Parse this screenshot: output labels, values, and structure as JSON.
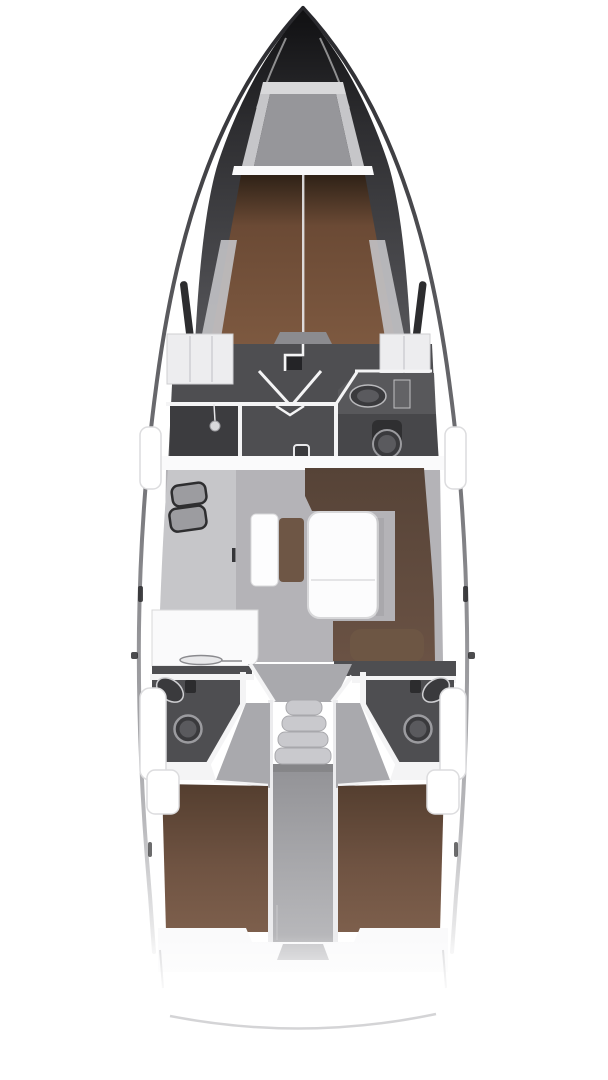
{
  "diagram": {
    "type": "yacht-interior-floor-plan",
    "orientation": "bow-up"
  },
  "colors": {
    "page_bg": "#ffffff",
    "bow_tip": "#101012",
    "bow_side": "#56565a",
    "hull_line_dark": "#26262a",
    "hull_line_mid": "#77777b",
    "hull_line_light": "#b9b9bc",
    "deck_white": "#ffffff",
    "deck_edge": "#d3d3d6",
    "locker_lid": "#d8d8da",
    "locker_rail": "#c6c6c9",
    "locker_floor": "#96969a",
    "shelf_white": "#fafafb",
    "berth_fore_top": "#2f2217",
    "berth_fore_mid": "#6b4a35",
    "berth_fore_low": "#7d5940",
    "berth_side_shelf": "#c2c2c5",
    "step_notch": "#8b8b8f",
    "wall_dark": "#4e4e51",
    "wall_white": "#f4f4f5",
    "wardrobe_white": "#ededef",
    "wardrobe_line": "#cfcfd2",
    "mast_dark": "#242427",
    "floor_shower": "#3c3c3f",
    "counter_head": "#58585b",
    "floor_head": "#47474a",
    "fixture_dark": "#3a3a3d",
    "fixture_mid": "#5a5a5e",
    "fixture_ring": "#9b9b9f",
    "floor_salon": "#b4b3b7",
    "galley_counter": "#c6c6c9",
    "sink_dark": "#2e2e30",
    "sink_inner": "#9c9ca0",
    "galley_white": "#fafafb",
    "bench_white": "#fdfdfe",
    "cushion_brown": "#6e5645",
    "sofa_top": "#564337",
    "sofa_low": "#6a5244",
    "table_white": "#fcfcfd",
    "table_edge": "#d8d8da",
    "floor_entry": "#a9a9ad",
    "step_fill": "#c9c9cd",
    "step_edge": "#a8a8ac",
    "engine_top": "#929296",
    "engine_low": "#b9b9bc",
    "rail_white": "#ececee",
    "berth_aft_top": "#543e2f",
    "berth_aft_low": "#7d5f4c",
    "window_slot": "#2d2d2f",
    "coaming_edge": "#dcdcde",
    "stern_line": "#cfcfd1"
  }
}
